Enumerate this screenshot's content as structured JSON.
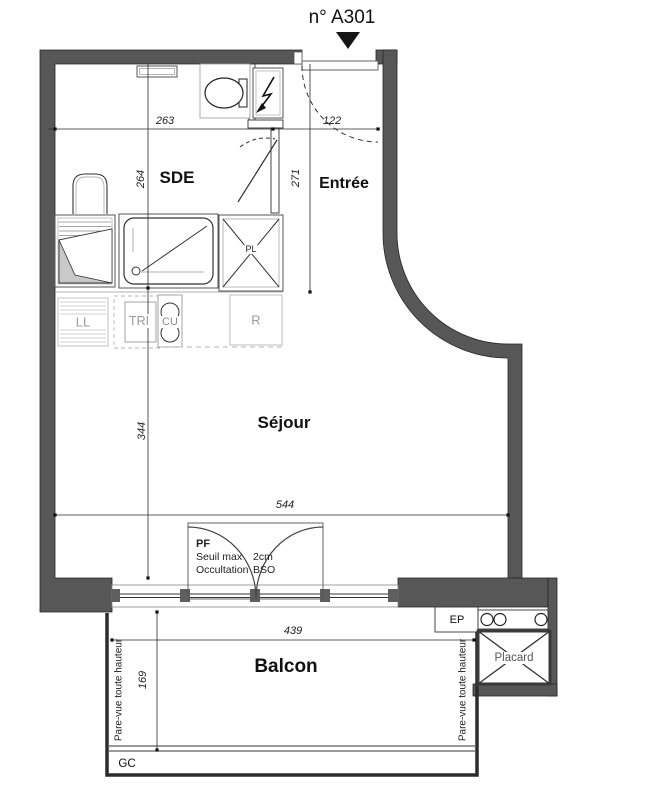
{
  "header": {
    "unit_label": "n° A301"
  },
  "rooms": {
    "sde": "SDE",
    "entree": "Entrée",
    "sejour": "Séjour",
    "balcon": "Balcon"
  },
  "dims": {
    "sde_width": "263",
    "entree_width": "122",
    "sde_height": "264",
    "entree_height": "271",
    "sejour_height": "344",
    "sejour_width": "544",
    "balcon_width": "439",
    "balcon_height": "169"
  },
  "fixtures": {
    "washing_machine": "LL",
    "sorting_bin": "TRI",
    "cooktop": "CU",
    "fridge": "R",
    "small_closet": "PL",
    "closet": "Placard",
    "rainwater_pipe": "EP",
    "gc": "GC"
  },
  "window_note": {
    "type": "PF",
    "seuil_label": "Seuil max",
    "seuil_value": "2cm",
    "occultation_label": "Occultation",
    "occultation_value": "BSO"
  },
  "annotations": {
    "pare_vue": "Pare-vue toute hauteur"
  },
  "colors": {
    "wall": "#575757",
    "line": "#1a1a1a",
    "muted_label": "#9c9c9c",
    "shade": "#c9c9c9"
  }
}
